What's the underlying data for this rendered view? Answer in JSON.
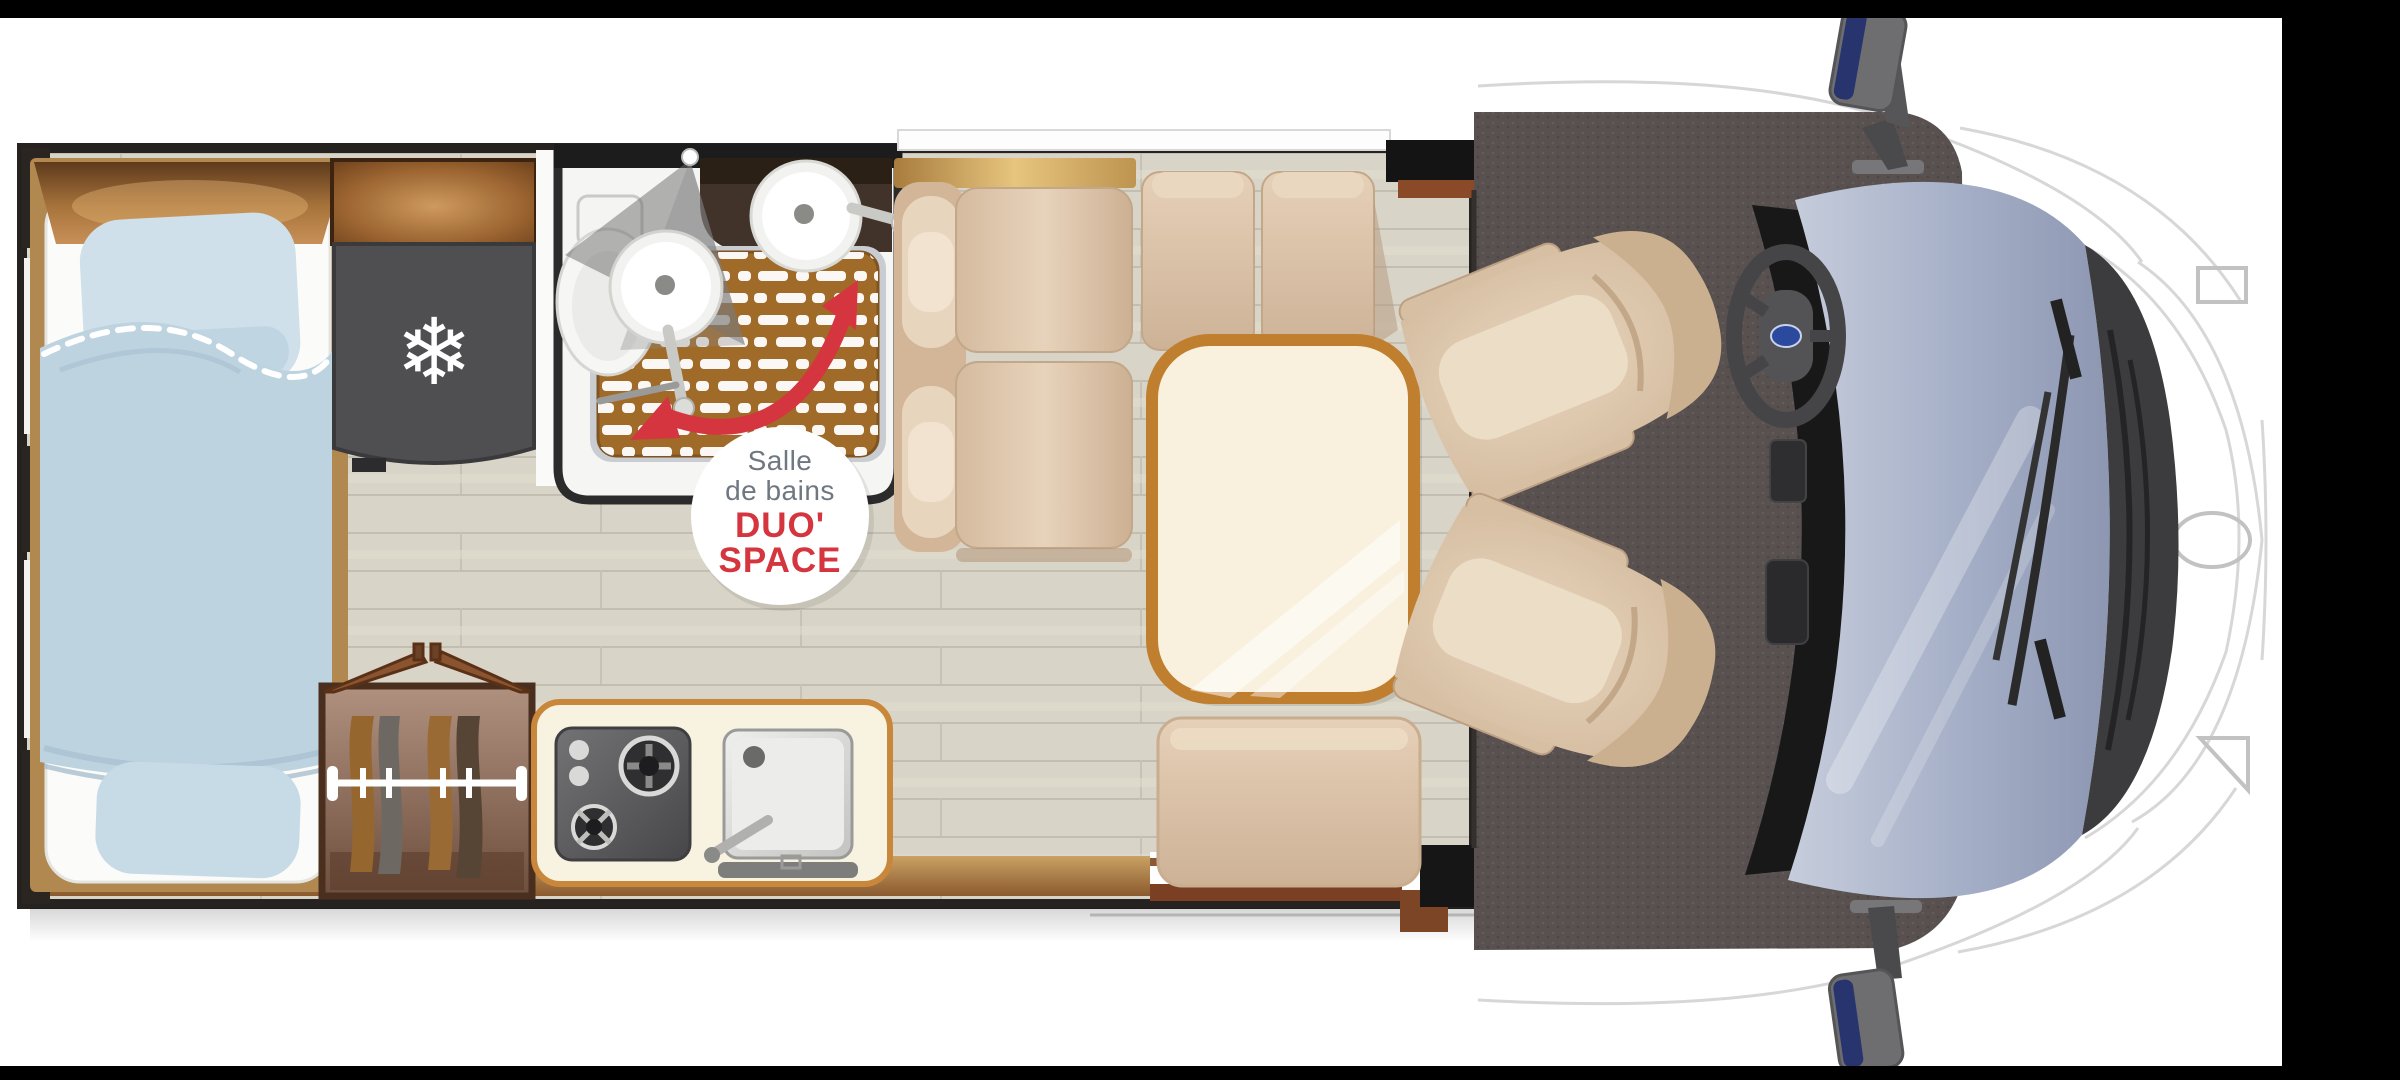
{
  "meta": {
    "description": "Motorhome / campervan floor plan, top-down view, cab at right",
    "width_px": 2400,
    "height_px": 1080
  },
  "badge": {
    "line1": "Salle",
    "line2": "de bains",
    "line3": "DUO'",
    "line4": "SPACE",
    "text_color": "#6f7780",
    "accent_color": "#d5353f"
  },
  "icons": {
    "snowflake_glyph": "❄"
  },
  "palette": {
    "background": "#000000",
    "canvas": "#ffffff",
    "floor_wood": "#d8d4c7",
    "cab_carpet": "#585150",
    "upholstery_beige": "#ddc8ae",
    "table_border": "#bf7f2e",
    "table_top": "#f9f1dd",
    "bedding_blue": "#bdd3df",
    "pillow_blue": "#cfe0ea",
    "wardrobe_wood": "#8a6a58",
    "shower_grate_wood": "#a06b28",
    "wall_dark": "#26221f",
    "wall_wood": "#b08850",
    "windshield_glass": "#aab6cc",
    "fridge_gray": "#4f4f51",
    "appliance_gray": "#5a5a5c",
    "steering_logo_blue": "#2b4a9e",
    "accent_red": "#d5353f"
  }
}
